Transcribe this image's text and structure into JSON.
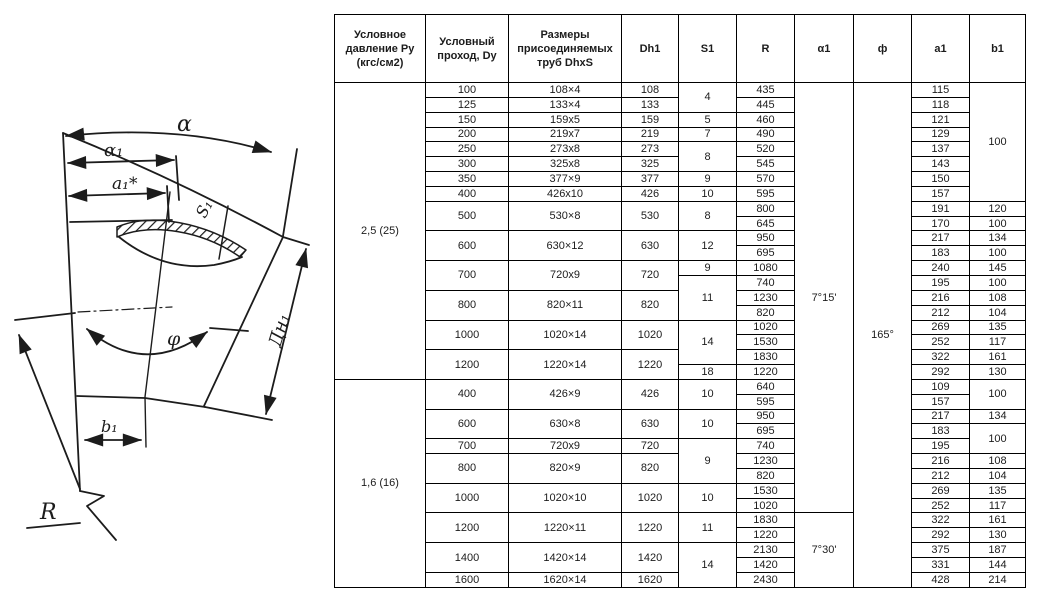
{
  "diagram": {
    "labels": {
      "alpha": "α",
      "alpha1": "α₁",
      "a1_star": "a₁*",
      "s1": "S₁",
      "dn1": "Дн₁",
      "phi": "φ",
      "b1": "b₁",
      "r": "R"
    }
  },
  "table": {
    "headers": [
      "Условное давление Ру (кгс/см2)",
      "Условный проход, Dy",
      "Размеры присоединяемых труб DhxS",
      "Dh1",
      "S1",
      "R",
      "α1",
      "ф",
      "a1",
      "b1"
    ],
    "rows": [
      [
        {
          "t": "2,5 (25)",
          "rs": 20,
          "cls": "press"
        },
        {
          "t": "100"
        },
        {
          "t": "108×4"
        },
        {
          "t": "108"
        },
        {
          "t": "4",
          "rs": 2
        },
        {
          "t": "435"
        },
        {
          "t": "7°15'",
          "rs": 29
        },
        {
          "t": "165°",
          "rs": 34
        },
        {
          "t": "115"
        },
        {
          "t": "100",
          "rs": 8
        }
      ],
      [
        {
          "t": "125"
        },
        {
          "t": "133×4"
        },
        {
          "t": "133"
        },
        {
          "t": "445"
        },
        {
          "t": "118"
        }
      ],
      [
        {
          "t": "150"
        },
        {
          "t": "159x5"
        },
        {
          "t": "159"
        },
        {
          "t": "5"
        },
        {
          "t": "460"
        },
        {
          "t": "121"
        }
      ],
      [
        {
          "t": "200"
        },
        {
          "t": "219x7"
        },
        {
          "t": "219"
        },
        {
          "t": "7"
        },
        {
          "t": "490"
        },
        {
          "t": "129"
        }
      ],
      [
        {
          "t": "250"
        },
        {
          "t": "273x8"
        },
        {
          "t": "273"
        },
        {
          "t": "8",
          "rs": 2
        },
        {
          "t": "520"
        },
        {
          "t": "137"
        }
      ],
      [
        {
          "t": "300"
        },
        {
          "t": "325x8"
        },
        {
          "t": "325"
        },
        {
          "t": "545"
        },
        {
          "t": "143"
        }
      ],
      [
        {
          "t": "350"
        },
        {
          "t": "377×9"
        },
        {
          "t": "377"
        },
        {
          "t": "9"
        },
        {
          "t": "570"
        },
        {
          "t": "150"
        }
      ],
      [
        {
          "t": "400"
        },
        {
          "t": "426x10"
        },
        {
          "t": "426"
        },
        {
          "t": "10"
        },
        {
          "t": "595"
        },
        {
          "t": "157"
        }
      ],
      [
        {
          "t": "500",
          "rs": 2
        },
        {
          "t": "530×8",
          "rs": 2
        },
        {
          "t": "530",
          "rs": 2
        },
        {
          "t": "8",
          "rs": 2
        },
        {
          "t": "800"
        },
        {
          "t": "191"
        },
        {
          "t": "120"
        }
      ],
      [
        {
          "t": "645"
        },
        {
          "t": "170"
        },
        {
          "t": "100"
        }
      ],
      [
        {
          "t": "600",
          "rs": 2
        },
        {
          "t": "630×12",
          "rs": 2
        },
        {
          "t": "630",
          "rs": 2
        },
        {
          "t": "12",
          "rs": 2
        },
        {
          "t": "950"
        },
        {
          "t": "217"
        },
        {
          "t": "134"
        }
      ],
      [
        {
          "t": "695"
        },
        {
          "t": "183"
        },
        {
          "t": "100"
        }
      ],
      [
        {
          "t": "700",
          "rs": 2
        },
        {
          "t": "720x9",
          "rs": 2
        },
        {
          "t": "720",
          "rs": 2
        },
        {
          "t": "9"
        },
        {
          "t": "1080"
        },
        {
          "t": "240"
        },
        {
          "t": "145"
        }
      ],
      [
        {
          "t": "11",
          "rs": 3
        },
        {
          "t": "740"
        },
        {
          "t": "195"
        },
        {
          "t": "100"
        }
      ],
      [
        {
          "t": "800",
          "rs": 2
        },
        {
          "t": "820×11",
          "rs": 2
        },
        {
          "t": "820",
          "rs": 2
        },
        {
          "t": "1230"
        },
        {
          "t": "216"
        },
        {
          "t": "108"
        }
      ],
      [
        {
          "t": "820"
        },
        {
          "t": "212"
        },
        {
          "t": "104"
        }
      ],
      [
        {
          "t": "1000",
          "rs": 2
        },
        {
          "t": "1020×14",
          "rs": 2
        },
        {
          "t": "1020",
          "rs": 2
        },
        {
          "t": "14",
          "rs": 3
        },
        {
          "t": "1020"
        },
        {
          "t": "269"
        },
        {
          "t": "135"
        }
      ],
      [
        {
          "t": "1530"
        },
        {
          "t": "252"
        },
        {
          "t": "117"
        }
      ],
      [
        {
          "t": "1200",
          "rs": 2
        },
        {
          "t": "1220×14",
          "rs": 2
        },
        {
          "t": "1220",
          "rs": 2
        },
        {
          "t": "1830"
        },
        {
          "t": "322"
        },
        {
          "t": "161"
        }
      ],
      [
        {
          "t": "18"
        },
        {
          "t": "1220"
        },
        {
          "t": "292"
        },
        {
          "t": "130"
        }
      ],
      [
        {
          "t": "1,6 (16)",
          "rs": 14,
          "cls": "press"
        },
        {
          "t": "400",
          "rs": 2
        },
        {
          "t": "426×9",
          "rs": 2
        },
        {
          "t": "426",
          "rs": 2
        },
        {
          "t": "10",
          "rs": 2
        },
        {
          "t": "640"
        },
        {
          "t": "109"
        },
        {
          "t": "100",
          "rs": 2
        }
      ],
      [
        {
          "t": "595"
        },
        {
          "t": "157"
        }
      ],
      [
        {
          "t": "600",
          "rs": 2
        },
        {
          "t": "630×8",
          "rs": 2
        },
        {
          "t": "630",
          "rs": 2
        },
        {
          "t": "10",
          "rs": 2
        },
        {
          "t": "950"
        },
        {
          "t": "217"
        },
        {
          "t": "134"
        }
      ],
      [
        {
          "t": "695"
        },
        {
          "t": "183"
        },
        {
          "t": "100",
          "rs": 2
        }
      ],
      [
        {
          "t": "700"
        },
        {
          "t": "720x9"
        },
        {
          "t": "720"
        },
        {
          "t": "9",
          "rs": 3
        },
        {
          "t": "740"
        },
        {
          "t": "195"
        }
      ],
      [
        {
          "t": "800",
          "rs": 2
        },
        {
          "t": "820×9",
          "rs": 2
        },
        {
          "t": "820",
          "rs": 2
        },
        {
          "t": "1230"
        },
        {
          "t": "216"
        },
        {
          "t": "108"
        }
      ],
      [
        {
          "t": "820"
        },
        {
          "t": "212"
        },
        {
          "t": "104"
        }
      ],
      [
        {
          "t": "1000",
          "rs": 2
        },
        {
          "t": "1020×10",
          "rs": 2
        },
        {
          "t": "1020",
          "rs": 2
        },
        {
          "t": "10",
          "rs": 2
        },
        {
          "t": "1530"
        },
        {
          "t": "269"
        },
        {
          "t": "135"
        }
      ],
      [
        {
          "t": "1020"
        },
        {
          "t": "252"
        },
        {
          "t": "117"
        }
      ],
      [
        {
          "t": "1200",
          "rs": 2
        },
        {
          "t": "1220×11",
          "rs": 2
        },
        {
          "t": "1220",
          "rs": 2
        },
        {
          "t": "11",
          "rs": 2
        },
        {
          "t": "1830"
        },
        {
          "t": "7°30'",
          "rs": 5
        },
        {
          "t": "322"
        },
        {
          "t": "161"
        }
      ],
      [
        {
          "t": "1220"
        },
        {
          "t": "292"
        },
        {
          "t": "130"
        }
      ],
      [
        {
          "t": "1400",
          "rs": 2
        },
        {
          "t": "1420×14",
          "rs": 2
        },
        {
          "t": "1420",
          "rs": 2
        },
        {
          "t": "14",
          "rs": 3
        },
        {
          "t": "2130"
        },
        {
          "t": "375"
        },
        {
          "t": "187"
        }
      ],
      [
        {
          "t": "1420"
        },
        {
          "t": "331"
        },
        {
          "t": "144"
        }
      ],
      [
        {
          "t": "1600"
        },
        {
          "t": "1620×14"
        },
        {
          "t": "1620"
        },
        {
          "t": "2430"
        },
        {
          "t": "428"
        },
        {
          "t": "214"
        }
      ]
    ],
    "column_widths": [
      91,
      83,
      113,
      57,
      58,
      58,
      59,
      58,
      58,
      56
    ],
    "ink_color": "#1c1c1c"
  }
}
